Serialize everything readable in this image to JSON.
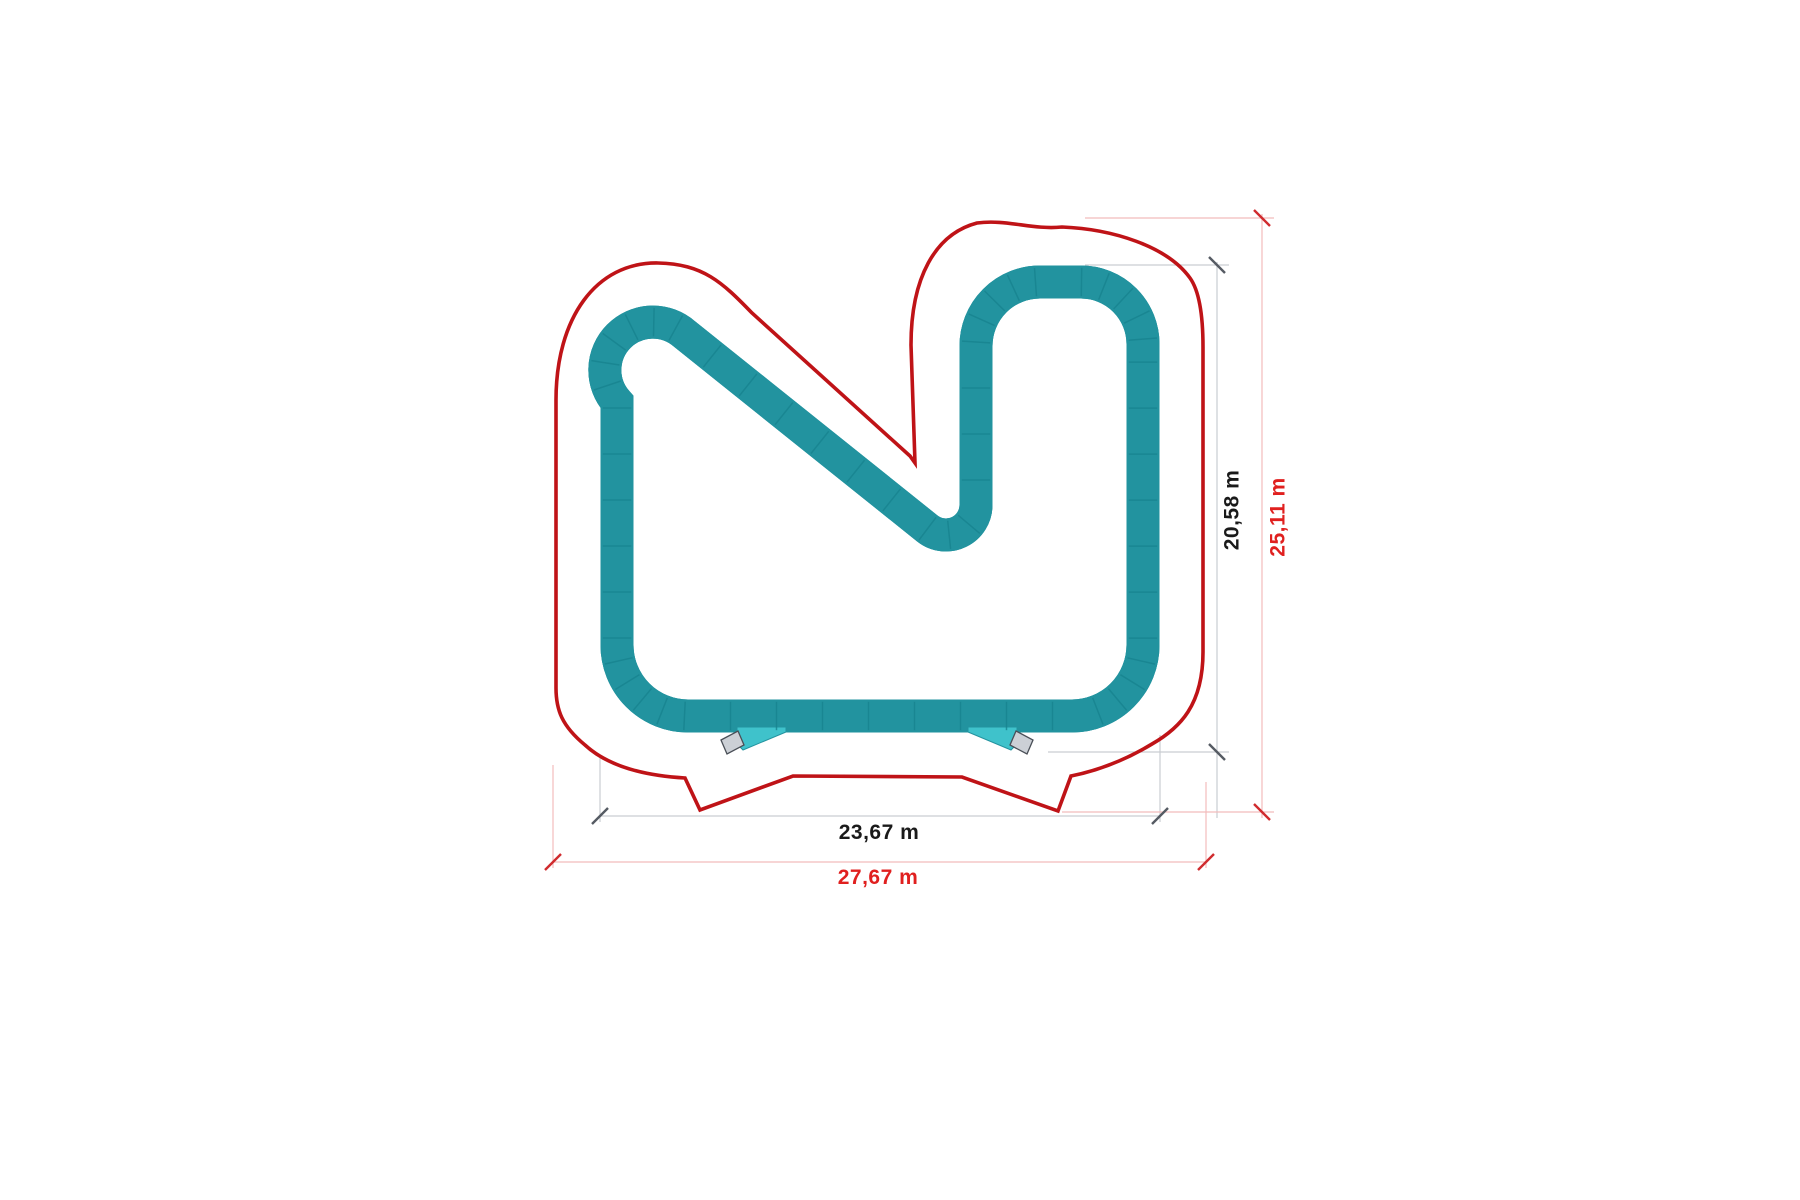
{
  "diagram": {
    "type": "pump-track-floor-plan",
    "labels": {
      "track_height": "20,58 m",
      "overall_height": "25,11 m",
      "track_width": "23,67 m",
      "overall_width": "27,67 m"
    },
    "colors": {
      "track_fill": "#3fc2cb",
      "track_edge": "#23939f",
      "track_inner_highlight": "#4ac9d2",
      "track_seam": "#17838f",
      "boundary_red": "#bf1317",
      "dim_line_gray": "#c9cdd2",
      "dim_line_pink": "#f2bcbc",
      "tick_gray": "#555b63",
      "tick_red": "#d02b2e",
      "label_black": "#1a1a1a",
      "label_red": "#e0201f",
      "ramp_fill": "#ccd0d6",
      "ramp_edge": "#4a4f57"
    }
  }
}
